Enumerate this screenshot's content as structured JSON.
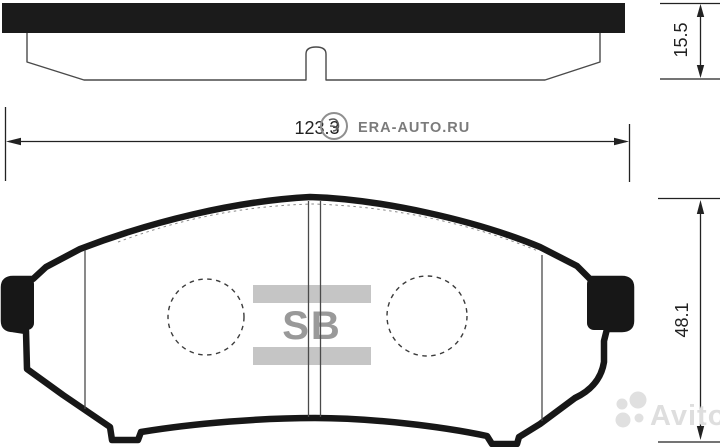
{
  "drawing": {
    "type": "brake-pad-technical-drawing",
    "views": [
      "top-profile-view",
      "front-view"
    ]
  },
  "dimensions": {
    "length": "123.3",
    "thickness": "15.5",
    "height": "48.1"
  },
  "logo": {
    "brand_text": "SB"
  },
  "watermarks": {
    "era_auto": "ERA-AUTO.RU",
    "avito": "Avito"
  },
  "colors": {
    "outline_black": "#171717",
    "thin_line": "#4a4a4a",
    "dashed_line": "#3c3c3c",
    "logo_bar_gray": "#c5c5c5",
    "logo_text_gray": "#999999",
    "era_watermark_gray": "#7b7b7b",
    "era_ring_gray": "#8f8f8f",
    "avito_watermark_gray": "#dedede",
    "dimension_text": "#222222",
    "background": "#ffffff"
  }
}
